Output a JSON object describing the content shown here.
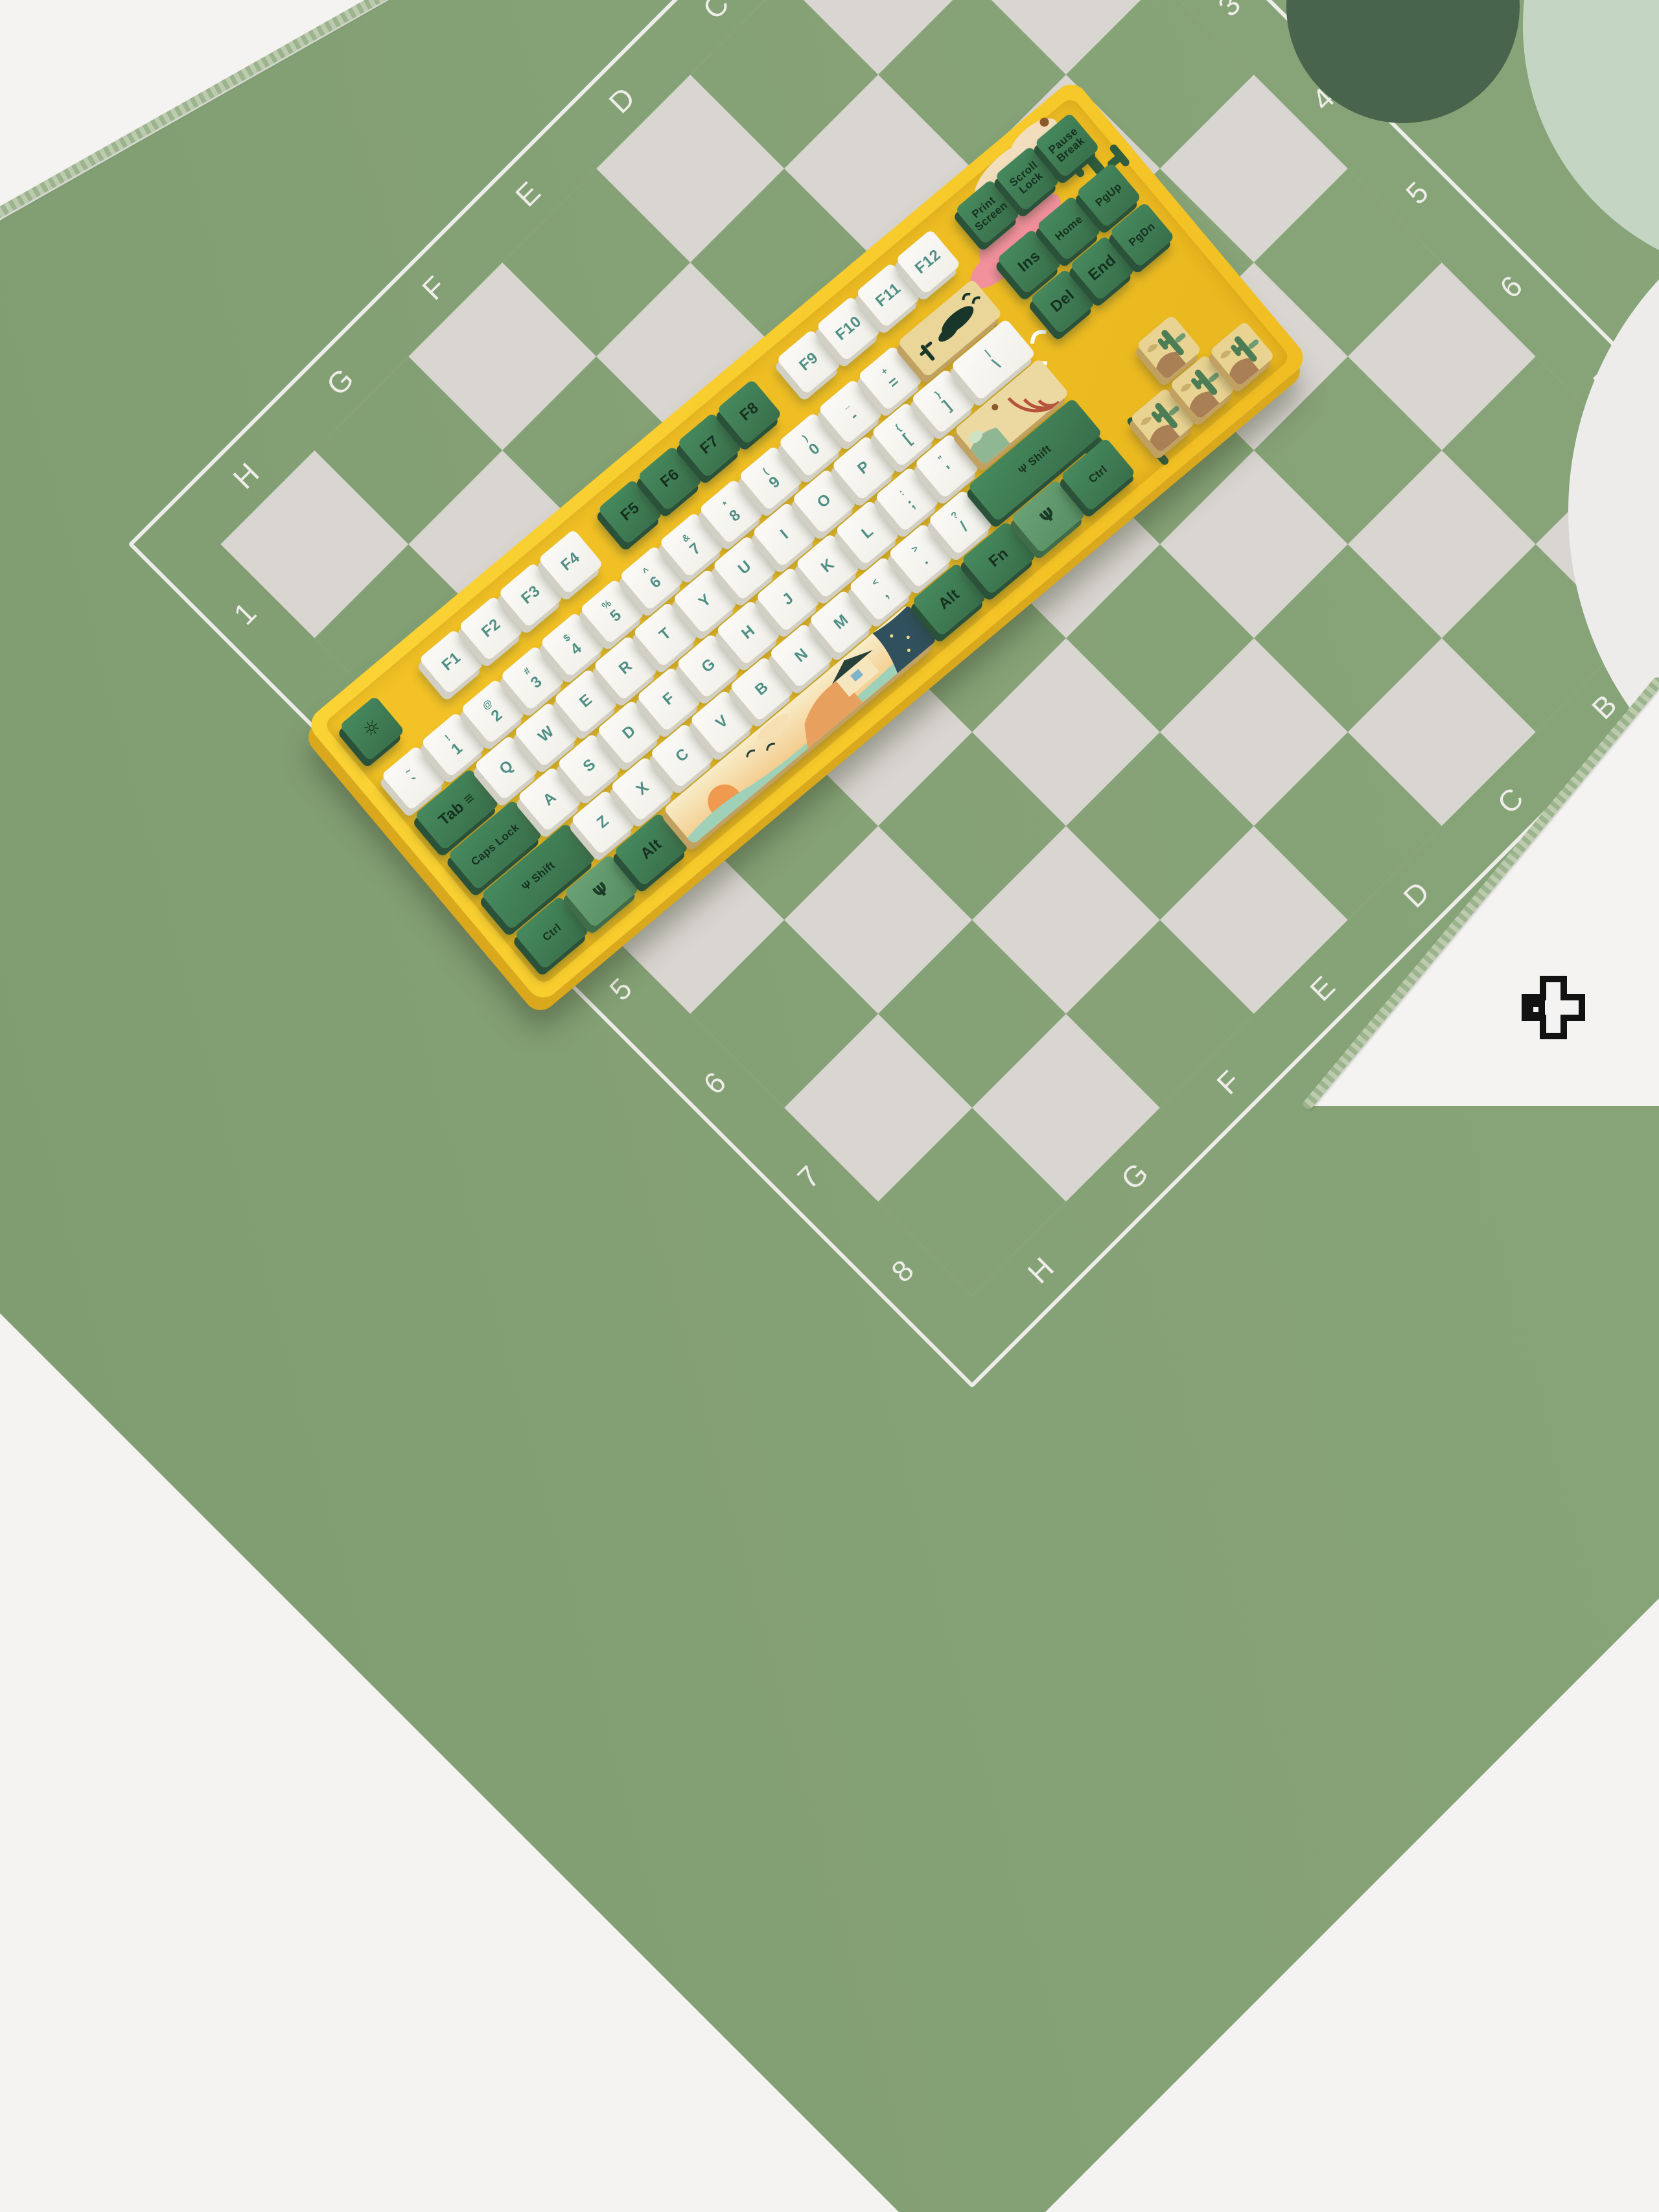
{
  "scene": {
    "description": "Yellow desert-themed mechanical keyboard lying diagonally on a green chessboard desk mat",
    "logo_name": "plus-cross-logo"
  },
  "palette": {
    "mat_green": "#85a276",
    "mat_square_white": "#d9d5d0",
    "mat_line": "#eeece8",
    "desk_white": "#f4f3f1",
    "case_yellow": "#f7ca2b",
    "keycap_green": "#3d7852",
    "keycap_light_green": "#5d9468",
    "keycap_white": "#f6f5f2",
    "legend_teal": "#4f8f85",
    "legend_dark_green": "#16301f",
    "art_sand": "#ead698"
  },
  "mat": {
    "top_letters": [
      "H",
      "G",
      "F",
      "E",
      "D",
      "C",
      "B",
      "A"
    ],
    "bottom_letters": [
      "H",
      "G",
      "F",
      "E",
      "D",
      "C",
      "B",
      "A"
    ],
    "left_numbers": [
      "1",
      "2",
      "3",
      "4",
      "5",
      "6",
      "7",
      "8"
    ],
    "right_numbers": [
      "1",
      "2",
      "3",
      "4",
      "5",
      "6",
      "7",
      "8"
    ]
  },
  "keyboard": {
    "frow": [
      {
        "n": "key-esc",
        "t": "g",
        "w": 1,
        "i": "sun",
        "l": ""
      },
      {
        "sp": 1
      },
      {
        "l": "F1",
        "t": "w"
      },
      {
        "l": "F2",
        "t": "w"
      },
      {
        "l": "F3",
        "t": "w"
      },
      {
        "l": "F4",
        "t": "w"
      },
      {
        "sp": 0.5
      },
      {
        "l": "F5",
        "t": "g"
      },
      {
        "l": "F6",
        "t": "g"
      },
      {
        "l": "F7",
        "t": "g"
      },
      {
        "l": "F8",
        "t": "g"
      },
      {
        "sp": 0.5
      },
      {
        "l": "F9",
        "t": "w"
      },
      {
        "l": "F10",
        "t": "w"
      },
      {
        "l": "F11",
        "t": "w"
      },
      {
        "l": "F12",
        "t": "w"
      }
    ],
    "row1": [
      {
        "s": "~",
        "l": "`"
      },
      {
        "s": "!",
        "l": "1"
      },
      {
        "s": "@",
        "l": "2"
      },
      {
        "s": "#",
        "l": "3"
      },
      {
        "s": "$",
        "l": "4"
      },
      {
        "s": "%",
        "l": "5"
      },
      {
        "s": "^",
        "l": "6"
      },
      {
        "s": "&",
        "l": "7"
      },
      {
        "s": "*",
        "l": "8"
      },
      {
        "s": "(",
        "l": "9"
      },
      {
        "s": ")",
        "l": "0"
      },
      {
        "s": "_",
        "l": "-"
      },
      {
        "s": "+",
        "l": "="
      },
      {
        "n": "key-backspace",
        "t": "art",
        "a": "bs",
        "w": 2,
        "l": ""
      }
    ],
    "row2": [
      {
        "l": "Tab",
        "t": "g",
        "w": 1.5,
        "i": "tab"
      },
      {
        "l": "Q"
      },
      {
        "l": "W"
      },
      {
        "l": "E"
      },
      {
        "l": "R"
      },
      {
        "l": "T"
      },
      {
        "l": "Y"
      },
      {
        "l": "U"
      },
      {
        "l": "I"
      },
      {
        "l": "O"
      },
      {
        "l": "P"
      },
      {
        "s": "{",
        "l": "["
      },
      {
        "s": "}",
        "l": "]"
      },
      {
        "s": "|",
        "l": "\\",
        "w": 1.5
      }
    ],
    "row3": [
      {
        "l": "Caps Lock",
        "t": "g",
        "w": 1.75
      },
      {
        "l": "A"
      },
      {
        "l": "S"
      },
      {
        "l": "D"
      },
      {
        "l": "F"
      },
      {
        "l": "G"
      },
      {
        "l": "H"
      },
      {
        "l": "J"
      },
      {
        "l": "K"
      },
      {
        "l": "L"
      },
      {
        "s": ":",
        "l": ";"
      },
      {
        "s": "\"",
        "l": "'"
      },
      {
        "n": "key-enter",
        "t": "art",
        "a": "enter",
        "w": 2.25,
        "l": ""
      }
    ],
    "row4": [
      {
        "l": "Shift",
        "t": "g",
        "w": 2.25,
        "i": "cactus"
      },
      {
        "l": "Z"
      },
      {
        "l": "X"
      },
      {
        "l": "C"
      },
      {
        "l": "V"
      },
      {
        "l": "B"
      },
      {
        "l": "N"
      },
      {
        "l": "M"
      },
      {
        "s": "<",
        "l": ","
      },
      {
        "s": ">",
        "l": "."
      },
      {
        "s": "?",
        "l": "/"
      },
      {
        "l": "Shift",
        "t": "g",
        "w": 2.75,
        "i": "cactus"
      }
    ],
    "row5": [
      {
        "l": "Ctrl",
        "t": "g",
        "w": 1.25
      },
      {
        "n": "key-win",
        "t": "lg",
        "w": 1.25,
        "i": "cactusOnly",
        "l": ""
      },
      {
        "l": "Alt",
        "t": "g",
        "w": 1.25
      },
      {
        "n": "key-space",
        "t": "art",
        "a": "space",
        "w": 6.25,
        "l": ""
      },
      {
        "l": "Alt",
        "t": "g",
        "w": 1.25
      },
      {
        "l": "Fn",
        "t": "g",
        "w": 1.25
      },
      {
        "n": "key-menu",
        "t": "lg",
        "w": 1.25,
        "i": "cactusOnly",
        "l": ""
      },
      {
        "l": "Ctrl",
        "t": "g",
        "w": 1.25
      }
    ],
    "nav": [
      [
        {
          "l": "Print Screen",
          "t": "g"
        },
        {
          "l": "Scroll Lock",
          "t": "g"
        },
        {
          "l": "Pause Break",
          "t": "g"
        }
      ],
      [
        {
          "l": "Ins",
          "t": "g"
        },
        {
          "l": "Home",
          "t": "g"
        },
        {
          "l": "PgUp",
          "t": "g"
        }
      ],
      [
        {
          "l": "Del",
          "t": "g"
        },
        {
          "l": "End",
          "t": "g"
        },
        {
          "l": "PgDn",
          "t": "g"
        }
      ]
    ],
    "arrows": {
      "up": {
        "n": "key-arrow-up"
      },
      "left": {
        "n": "key-arrow-left"
      },
      "down": {
        "n": "key-arrow-down"
      },
      "right": {
        "n": "key-arrow-right"
      }
    }
  }
}
